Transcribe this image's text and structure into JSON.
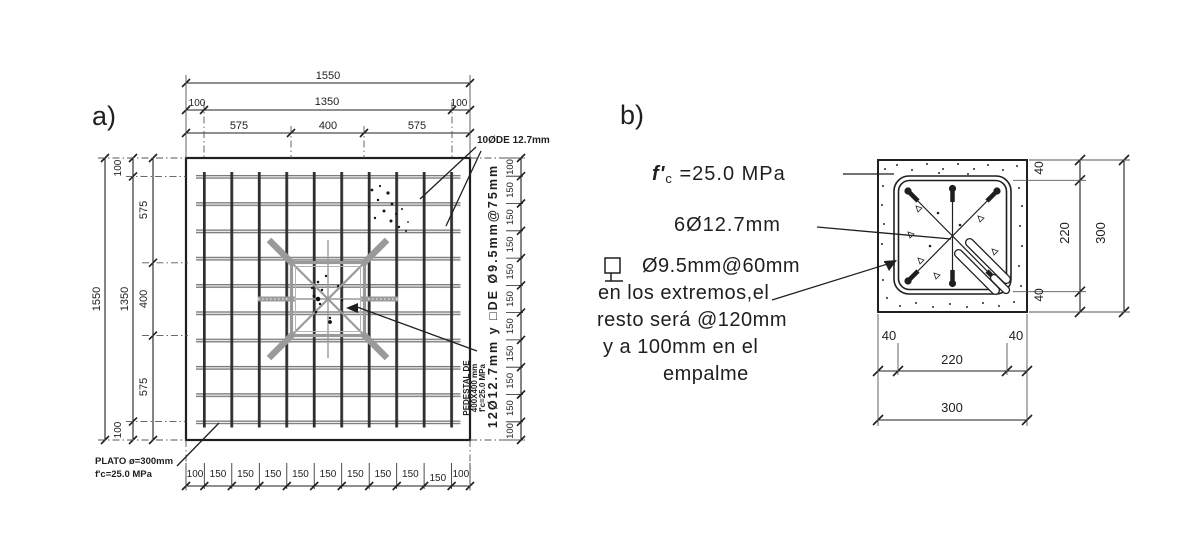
{
  "colors": {
    "ink": "#1f1f1f",
    "steel_gray": "#9a9a9a",
    "bar_dark": "#2f2f2f",
    "bar_gray": "#767676"
  },
  "a": {
    "label": "a)",
    "top": {
      "total": "1550",
      "margins": [
        "100",
        "1350",
        "100"
      ],
      "segments": [
        "575",
        "400",
        "575"
      ]
    },
    "left": {
      "total": "1550",
      "inner": "1350",
      "margin_top": "100",
      "margin_bottom": "100",
      "segments": [
        "575",
        "400",
        "575"
      ]
    },
    "bottom": [
      "100",
      "150",
      "150",
      "150",
      "150",
      "150",
      "150",
      "150",
      "150",
      "150",
      "100"
    ],
    "right": [
      "100",
      "150",
      "150",
      "150",
      "150",
      "150",
      "150",
      "150",
      "150",
      "150",
      "100"
    ],
    "top_bars_label": "10ØDE 12.7mm",
    "pedestal_vertical_note": "12Ø12.7mm y □DE Ø9.5mm@75mm",
    "pedestal_lines": [
      "PEDESTAL DE",
      "400X400 mm",
      "f'c=25.0 MPa"
    ],
    "plate_lines": [
      "PLATO ø=300mm",
      "f'c=25.0 MPa"
    ]
  },
  "b": {
    "label": "b)",
    "fc_prefix": "f'",
    "fc_sub": "c",
    "fc_value": " =25.0 MPa",
    "bars_label": "6Ø12.7mm",
    "stirrup_note": [
      "Ø9.5mm@60mm",
      "en los extremos,el",
      "resto será @120mm",
      "y a 100mm en el",
      "empalme"
    ],
    "dims": {
      "cover_top": "40",
      "core_v": "220",
      "cover_bottom": "40",
      "height": "300",
      "cover_left": "40",
      "core_h": "220",
      "cover_right": "40",
      "width": "300"
    }
  }
}
